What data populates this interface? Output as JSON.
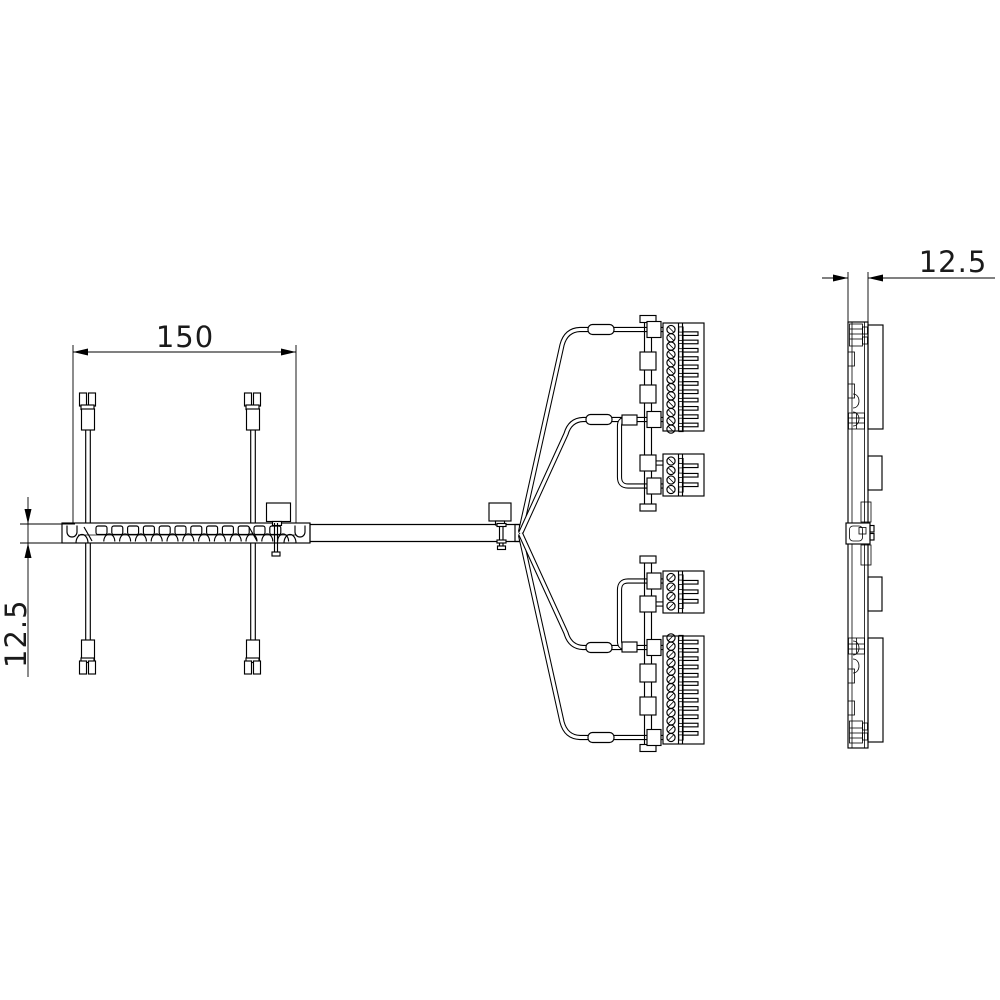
{
  "drawing": {
    "background_color": "#ffffff",
    "line_color": "#000000",
    "dimension_labels": {
      "front_width": "150",
      "front_height": "12.5",
      "side_depth": "12.5"
    },
    "front_view": {
      "rail_module_count": 12,
      "drop_cable_count": 2,
      "drop_cable_pin_count": 2
    },
    "connector_group": {
      "group_count": 2,
      "large_block_screw_count": 13,
      "small_block_screw_count": 4,
      "large_block_tooth_count": 12,
      "small_block_tooth_count": 3
    }
  }
}
